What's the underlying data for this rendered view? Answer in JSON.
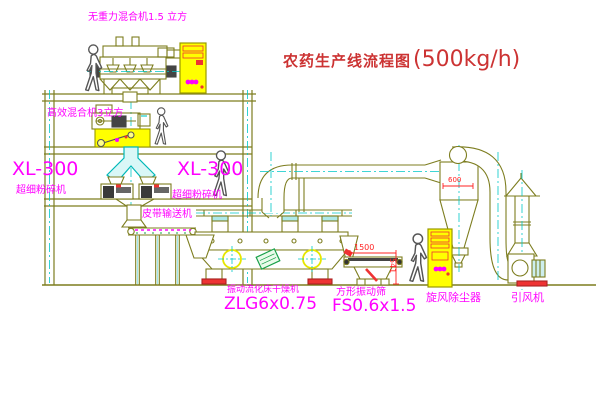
{
  "title": {
    "name": "农药生产线流程图",
    "capacity": "(500kg/h)"
  },
  "labels": {
    "gravity_mixer": "无重力混合机1.5 立方",
    "high_mixer": "高效混合机3立方",
    "mill_left_model": "XL-300",
    "mill_left_name": "超细粉碎机",
    "mill_right_model": "XL-300",
    "mill_right_name": "超细粉碎机",
    "conveyor": "皮带输送机",
    "dryer_name": "振动流化床干燥机",
    "dryer_model": "ZLG6x0.75",
    "screen_name": "方形振动筛",
    "screen_model": "FS0.6x1.5",
    "cyclone": "旋风除尘器",
    "fan": "引风机"
  },
  "dimensions": {
    "screen_length": "1500",
    "screen_height": "541",
    "cyclone_width": "600"
  },
  "colors": {
    "label": "#ff00ff",
    "title": "#cc3333",
    "line": "#7d7d1f",
    "centerline": "#00c8c8",
    "highlight": "#ffff00",
    "dimension": "#ff2222"
  }
}
